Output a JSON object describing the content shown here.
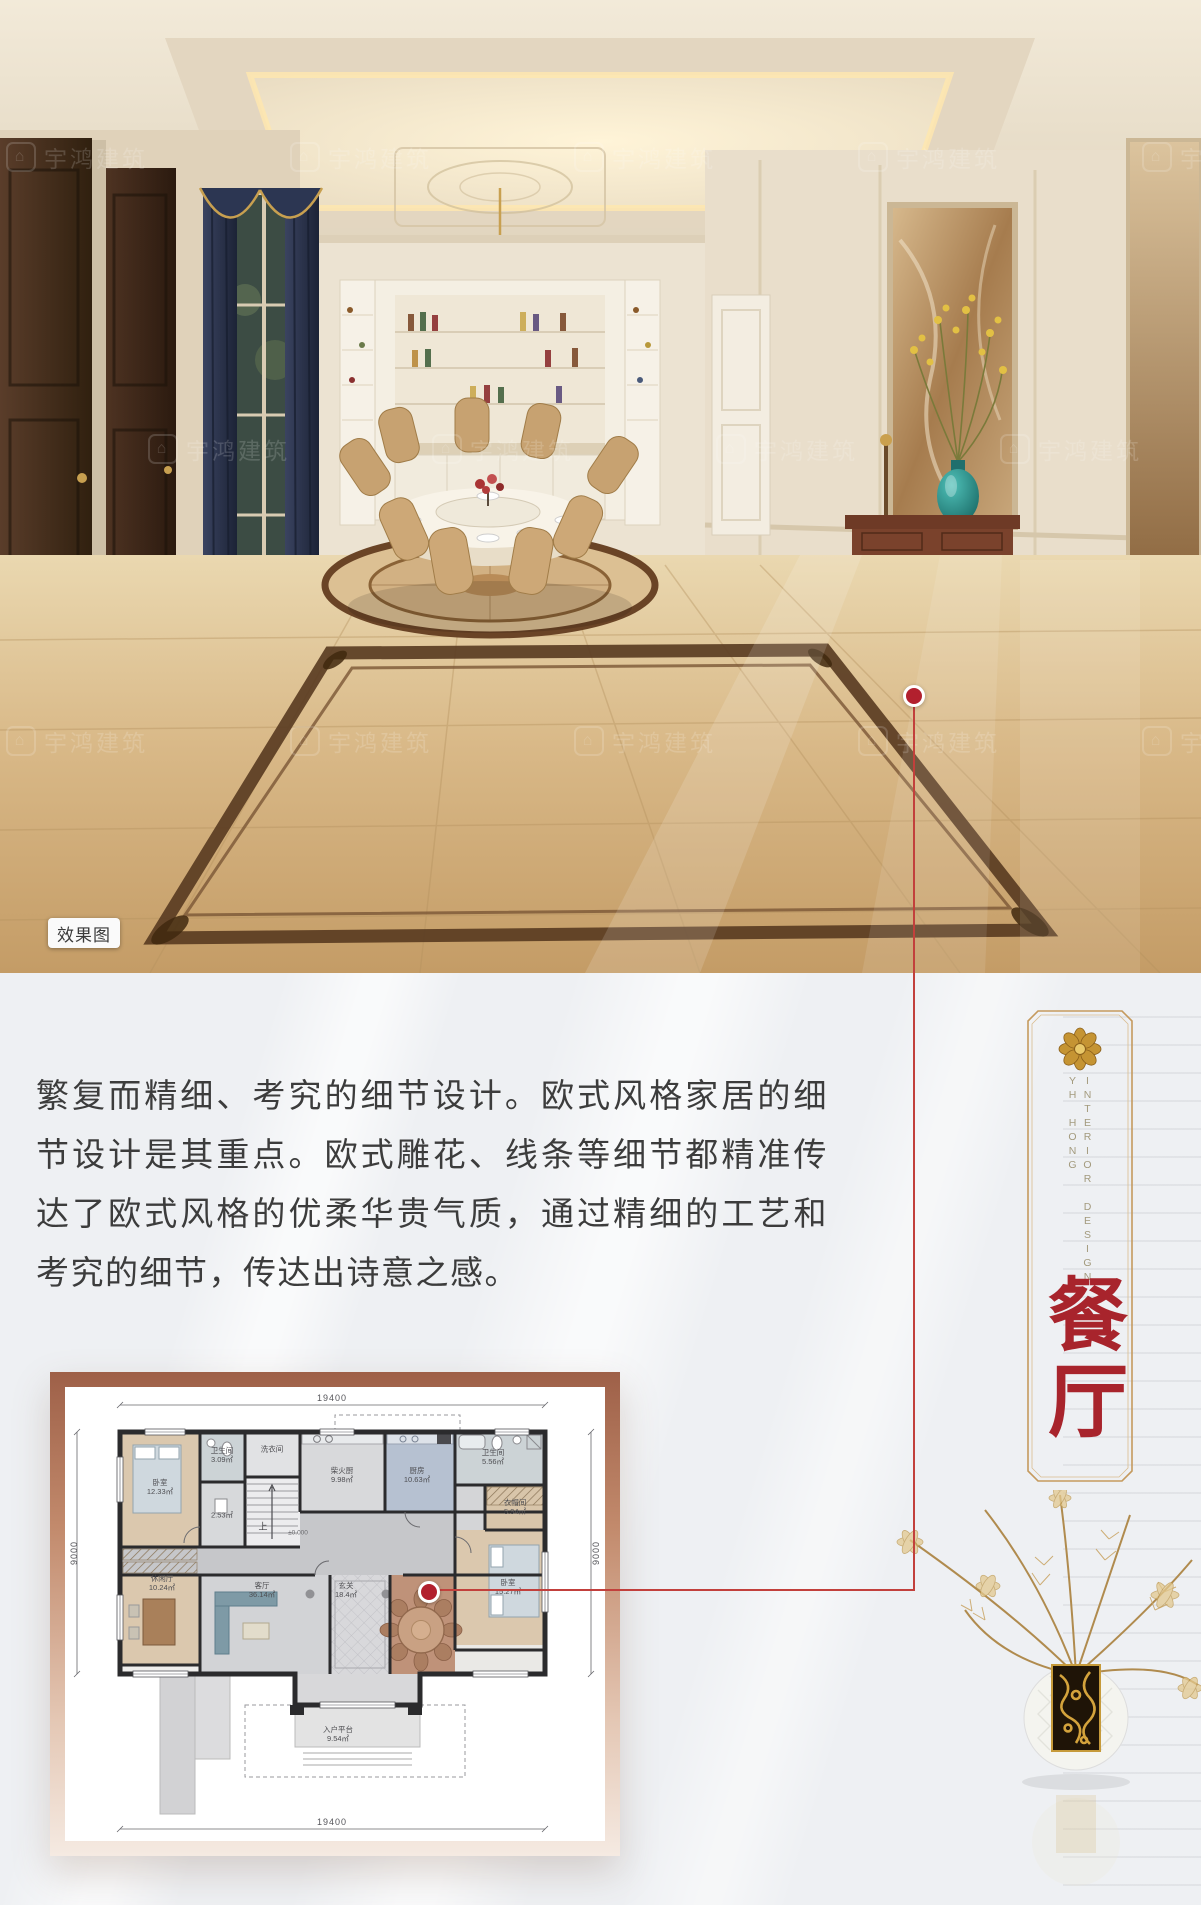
{
  "watermark": {
    "text": "宇鸿建筑"
  },
  "photo": {
    "badge_label": "效果图"
  },
  "article": {
    "paragraph": "繁复而精细、考究的细节设计。欧式风格家居的细节设计是其重点。欧式雕花、线条等细节都精准传达了欧式风格的优柔华贵气质，通过精细的工艺和考究的细节，传达出诗意之感。"
  },
  "side_panel": {
    "english_title": "INTERIOR DESIGN",
    "english_subtitle": "YH HONG",
    "room_title": "餐厅"
  },
  "floor_plan": {
    "dim_top": "19400",
    "dim_bottom": "19400",
    "dim_left": "9000",
    "dim_right": "9000",
    "stair_label": "上",
    "level_label": "±0.000",
    "rooms": {
      "bedroom_tl": {
        "name": "卧室",
        "area": "12.33㎡"
      },
      "bath_tl": {
        "name": "卫生间",
        "area": "3.09㎡"
      },
      "store": {
        "name": "",
        "area": "2.53㎡"
      },
      "laundry": {
        "name": "洗衣间",
        "area": ""
      },
      "wood_kitchen": {
        "name": "柴火厨",
        "area": "9.98㎡"
      },
      "kitchen": {
        "name": "厨房",
        "area": "10.63㎡"
      },
      "bath_tr": {
        "name": "卫生间",
        "area": "5.56㎡"
      },
      "cloak": {
        "name": "衣帽间",
        "area": "5.94㎡"
      },
      "bedroom_r": {
        "name": "卧室",
        "area": "15.27㎡"
      },
      "leisure": {
        "name": "休闲厅",
        "area": "10.24㎡"
      },
      "living": {
        "name": "客厅",
        "area": "36.14㎡"
      },
      "foyer": {
        "name": "玄关",
        "area": "18.4㎡"
      },
      "entry": {
        "name": "入户平台",
        "area": "9.54㎡"
      }
    }
  },
  "colors": {
    "accent_red": "#a8242c",
    "frame_gold": "#c59a5e",
    "connector_red": "#c2403c"
  }
}
